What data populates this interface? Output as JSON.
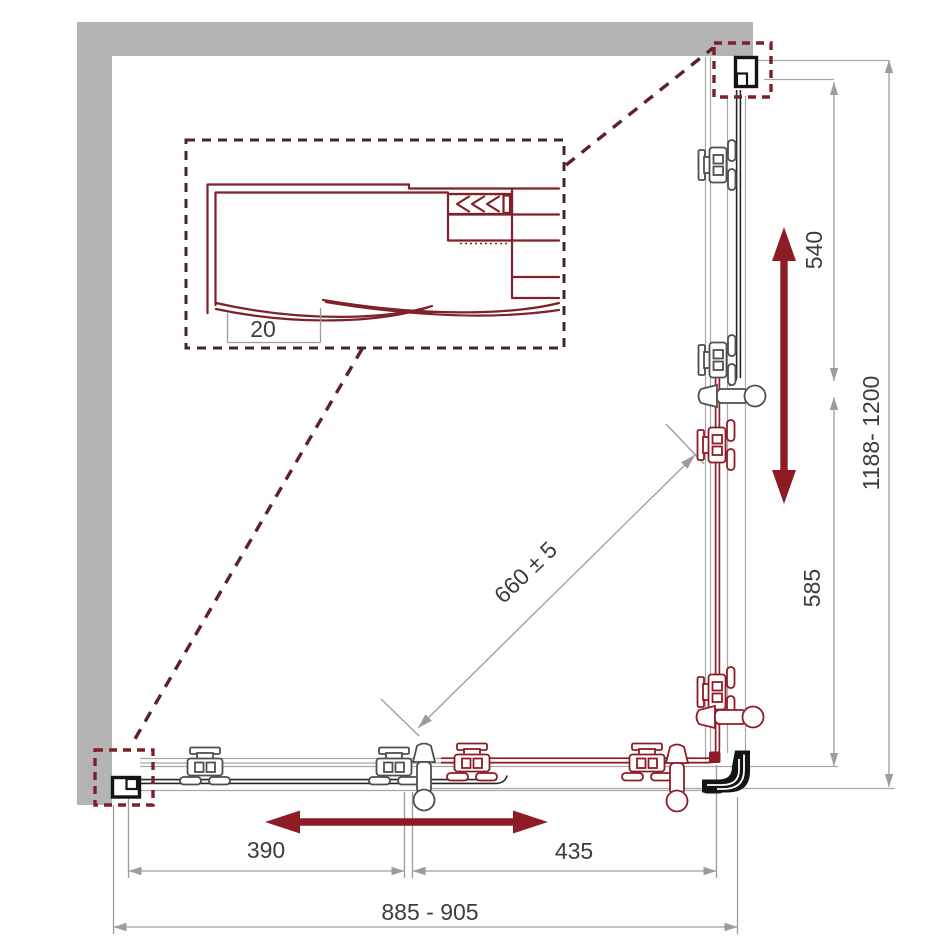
{
  "colors": {
    "bg": "#ffffff",
    "wall": "#b4b4b4",
    "rail_gray": "#a8a8a8",
    "dim_line": "#9c9c9c",
    "dim_text": "#3d3d3d",
    "maroon": "#8e1c27",
    "profile": "#7f2129",
    "dash_box": "#46262a",
    "dash_callout": "#7d2029",
    "dash_leader": "#5d2227",
    "glass": "#262626",
    "hw_gray": "#4f4f4f",
    "black_hw": "#141414"
  },
  "detail": {
    "seal_gap_label": "20"
  },
  "dimensions": {
    "upper_right_segment": "540",
    "lower_right_segment": "585",
    "right_overall": "1188- 1200",
    "diagonal_clearance": "660 ± 5",
    "bottom_left_segment": "390",
    "bottom_right_segment": "435",
    "bottom_overall": "885 - 905"
  }
}
